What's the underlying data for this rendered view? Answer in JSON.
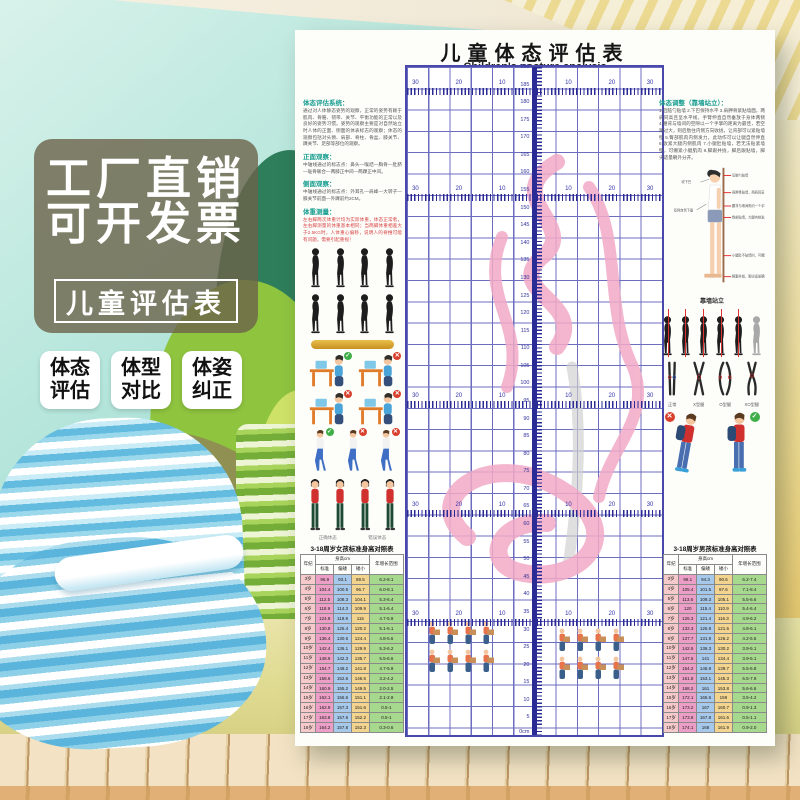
{
  "overlay": {
    "line1": "工厂直销",
    "line2": "可开发票",
    "box_label": "儿童评估表",
    "badges": [
      {
        "l1": "体态",
        "l2": "评估"
      },
      {
        "l1": "体型",
        "l2": "对比"
      },
      {
        "l1": "体姿",
        "l2": "纠正"
      }
    ]
  },
  "poster": {
    "title_cn": "儿童体态评估表",
    "title_en": "Children's posture analysis",
    "grid": {
      "ruler_max": 190,
      "ruler_step": 5,
      "ruler_zero_label": "0cm",
      "bands": {
        "positions_cm": [
          182,
          152,
          93,
          62,
          31
        ],
        "labels": [
          "30",
          "20",
          "10",
          "10",
          "20",
          "30"
        ],
        "label_x": [
          2,
          19,
          36,
          62,
          79,
          94
        ]
      }
    },
    "left": {
      "sections": [
        {
          "head": "体态评估系统：",
          "body": "通过对人体静态姿势的观察，正常的姿势有赖于肌肉、骨骼、韧带、关节、平衡功能的正常以及良好的姿势习惯。姿势的观察主要是对自然站立时人体的正面、侧面的体表标志的观察；体态的观察包括对头颈、肩部、脊柱、骨盆、膝关节、踝关节、足部等部位的观察。"
        },
        {
          "head": "正面观察：",
          "body": "中轴线通过的标志点：鼻头—喉结—胸骨—肚脐—耻骨联合—两膝正中间—两踝正中间。"
        },
        {
          "head": "侧面观察：",
          "body": "中轴线通过的标志点：外耳孔—肩峰—大转子—膝关节前面—外踝前约2CM。"
        },
        {
          "head": "体重测量：",
          "body": "左右脚两次体重计均为实际体重，体态正常者，左右脚测量的体重基本相同；当两脚体重相差大于2.5KG时，人体重心偏移，说明人的脊椎可能有问题，需要引起重视！"
        }
      ],
      "captions": [
        "正确体态",
        "错误体态"
      ]
    },
    "right": {
      "head": "体态调整（靠墙站立）：",
      "body": "1.后脑勺贴墙 2.下巴保持水平 3.肩胛骨紧贴墙面，两肩同高且呈水平线，手臂伸直自然垂放于身体两侧 4.腰背与墙间的空隙以一个手掌的距离为最佳，若空隙过大，则后肋往内侧方向收拢，让背部可以紧贴墙壁 5.臀部肌肉内侧发力，此动作可以让腿自然伸直 6.收紧大腿内侧肌肉 7.小腿肚贴墙，若无法贴紧墙壁，可绷紧小腿肌肉 8.脚跟并拢，脚后跟贴墙，脚尖适量朝外分开。",
      "wall_caption": "靠墙站立",
      "wall_labels_left": [
        "收下巴",
        "双臂自然下垂"
      ],
      "wall_labels_right": [
        "后脑勺贴墙",
        "肩胛骨贴墙，两肩同高",
        "腰背与墙间隙约一个手掌",
        "臀部贴墙，大腿内侧发力",
        "小腿肚不贴墙时，可绷紧小腿",
        "脚跟并拢，脚尖适量朝外"
      ],
      "leg_labels": [
        "正常",
        "X型腿",
        "O型腿",
        "XO型腿"
      ]
    }
  },
  "girls_table": {
    "title": "3-18周岁女孩标准身高对照表",
    "headers": {
      "age": "年纪",
      "height": "身高cm",
      "subs": [
        "标准",
        "偏矮",
        "矮小"
      ],
      "range": "年增长范围"
    },
    "rows": [
      [
        "3岁",
        "96.9",
        "93.1",
        "89.5",
        "6.2-8.1"
      ],
      [
        "4岁",
        "104.4",
        "100.5",
        "96.7",
        "6.0-8.1"
      ],
      [
        "5岁",
        "112.5",
        "108.3",
        "104.1",
        "5.3-6.4"
      ],
      [
        "6岁",
        "118.9",
        "114.3",
        "109.9",
        "5.1-6.4"
      ],
      [
        "7岁",
        "124.8",
        "119.9",
        "115",
        "4.7-5.9"
      ],
      [
        "8岁",
        "130.8",
        "125.4",
        "120.2",
        "5.1-6.1"
      ],
      [
        "9岁",
        "136.4",
        "130.6",
        "124.4",
        "4.8-5.6"
      ],
      [
        "10岁",
        "142.4",
        "136.1",
        "129.9",
        "5.3-6.2"
      ],
      [
        "11岁",
        "148.9",
        "142.3",
        "135.7",
        "5.5-6.6"
      ],
      [
        "12岁",
        "154.7",
        "148.2",
        "141.8",
        "4.7-5.9"
      ],
      [
        "13岁",
        "158.6",
        "152.6",
        "146.5",
        "3.2-4.2"
      ],
      [
        "14岁",
        "160.9",
        "155.2",
        "149.5",
        "2.0-2.5"
      ],
      [
        "15岁",
        "162.1",
        "156.6",
        "151.1",
        "2.1-2.9"
      ],
      [
        "16岁",
        "162.9",
        "157.3",
        "151.6",
        "0.5-1"
      ],
      [
        "17岁",
        "163.8",
        "157.6",
        "152.2",
        "0.5-1"
      ],
      [
        "18岁",
        "164.2",
        "157.8",
        "152.3",
        "0.3-0.6"
      ]
    ]
  },
  "boys_table": {
    "title": "3-18周岁男孩标准身高对照表",
    "headers": {
      "age": "年纪",
      "height": "身高cm",
      "subs": [
        "标准",
        "偏矮",
        "矮小"
      ],
      "range": "年增长范围"
    },
    "rows": [
      [
        "3岁",
        "98.1",
        "94.3",
        "90.6",
        "6.2-7.4"
      ],
      [
        "4岁",
        "105.4",
        "101.5",
        "97.6",
        "7.1-8.4"
      ],
      [
        "5岁",
        "113.6",
        "109.3",
        "105.1",
        "5.5-6.6"
      ],
      [
        "6岁",
        "120",
        "115.4",
        "110.9",
        "5.4-6.4"
      ],
      [
        "7岁",
        "126.3",
        "121.4",
        "116.3",
        "4.9-6.2"
      ],
      [
        "8岁",
        "132.3",
        "126.9",
        "121.6",
        "4.8-6.1"
      ],
      [
        "9岁",
        "137.7",
        "131.9",
        "126.2",
        "4.2-5.5"
      ],
      [
        "10岁",
        "142.5",
        "136.3",
        "130.2",
        "3.9-5.1"
      ],
      [
        "11岁",
        "147.6",
        "141",
        "134.4",
        "3.9-5.1"
      ],
      [
        "12岁",
        "154.2",
        "146.9",
        "139.7",
        "5.5-6.8"
      ],
      [
        "13岁",
        "161.8",
        "153.1",
        "145.3",
        "6.5-7.9"
      ],
      [
        "14岁",
        "168.2",
        "161",
        "153.8",
        "5.6-6.6"
      ],
      [
        "15岁",
        "172.1",
        "165.6",
        "159",
        "3.5-4.2"
      ],
      [
        "16岁",
        "173.2",
        "167",
        "160.7",
        "0.9-1.3"
      ],
      [
        "17岁",
        "173.8",
        "167.8",
        "161.6",
        "0.5-1.1"
      ],
      [
        "18岁",
        "174.1",
        "168",
        "161.9",
        "0.9-2.0"
      ]
    ]
  },
  "marks": {
    "bad": "✕",
    "good": "✓"
  },
  "colors": {
    "accent_teal": "#199e90",
    "grid_blue": "#2b2b96",
    "pink_art": "#f2aac6",
    "badge_bg": "#ffffff",
    "panel_bg": "#6c634a"
  }
}
